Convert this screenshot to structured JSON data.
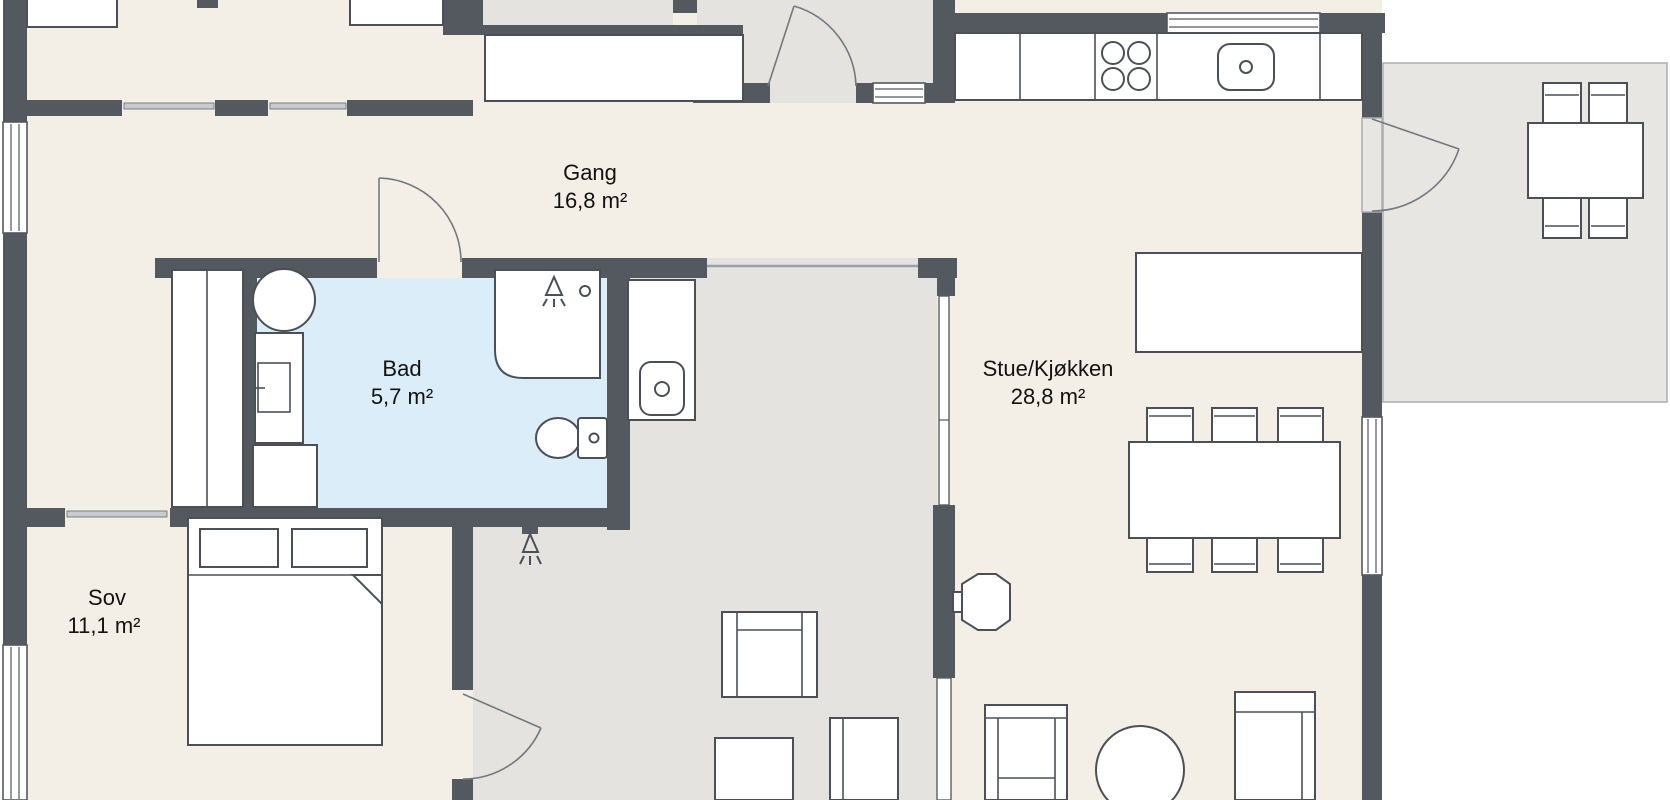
{
  "rooms": {
    "gang": {
      "name": "Gang",
      "area": "16,8 m²"
    },
    "bad": {
      "name": "Bad",
      "area": "5,7 m²"
    },
    "stue": {
      "name": "Stue/Kjøkken",
      "area": "28,8 m²"
    },
    "sov": {
      "name": "Sov",
      "area": "11,1 m²"
    }
  },
  "colors": {
    "wall": "#54585f",
    "interior_floor": "#f4efe6",
    "outdoor_floor": "#e4e3e0",
    "terrace_floor": "#e7e6e3",
    "bathroom_floor": "#daedf8",
    "furniture_fill": "#ffffff",
    "furniture_stroke": "#4c5056",
    "door_arc": "#74787e",
    "thin_line": "#9aa0a5",
    "text": "#121212",
    "background": "#ffffff"
  },
  "fixtures": [
    "kitchen-counter",
    "cooktop-four-burners",
    "kitchen-sink",
    "kitchen-window",
    "kitchen-island",
    "dining-table-six-chairs",
    "wood-stove",
    "outdoor-dining-table-four-chairs",
    "terrace",
    "covered-terrace",
    "outdoor-sink-counter",
    "outdoor-shower",
    "armchair",
    "sofa",
    "round-table",
    "double-bed",
    "pillows",
    "wardrobe",
    "closet-column",
    "hall-wardrobe",
    "bathroom-basin",
    "bathroom-vanity",
    "shower-cabin",
    "toilet",
    "entry-door",
    "terrace-door",
    "bathroom-door",
    "bedroom-terrace-door",
    "sliding-doors",
    "windows"
  ]
}
